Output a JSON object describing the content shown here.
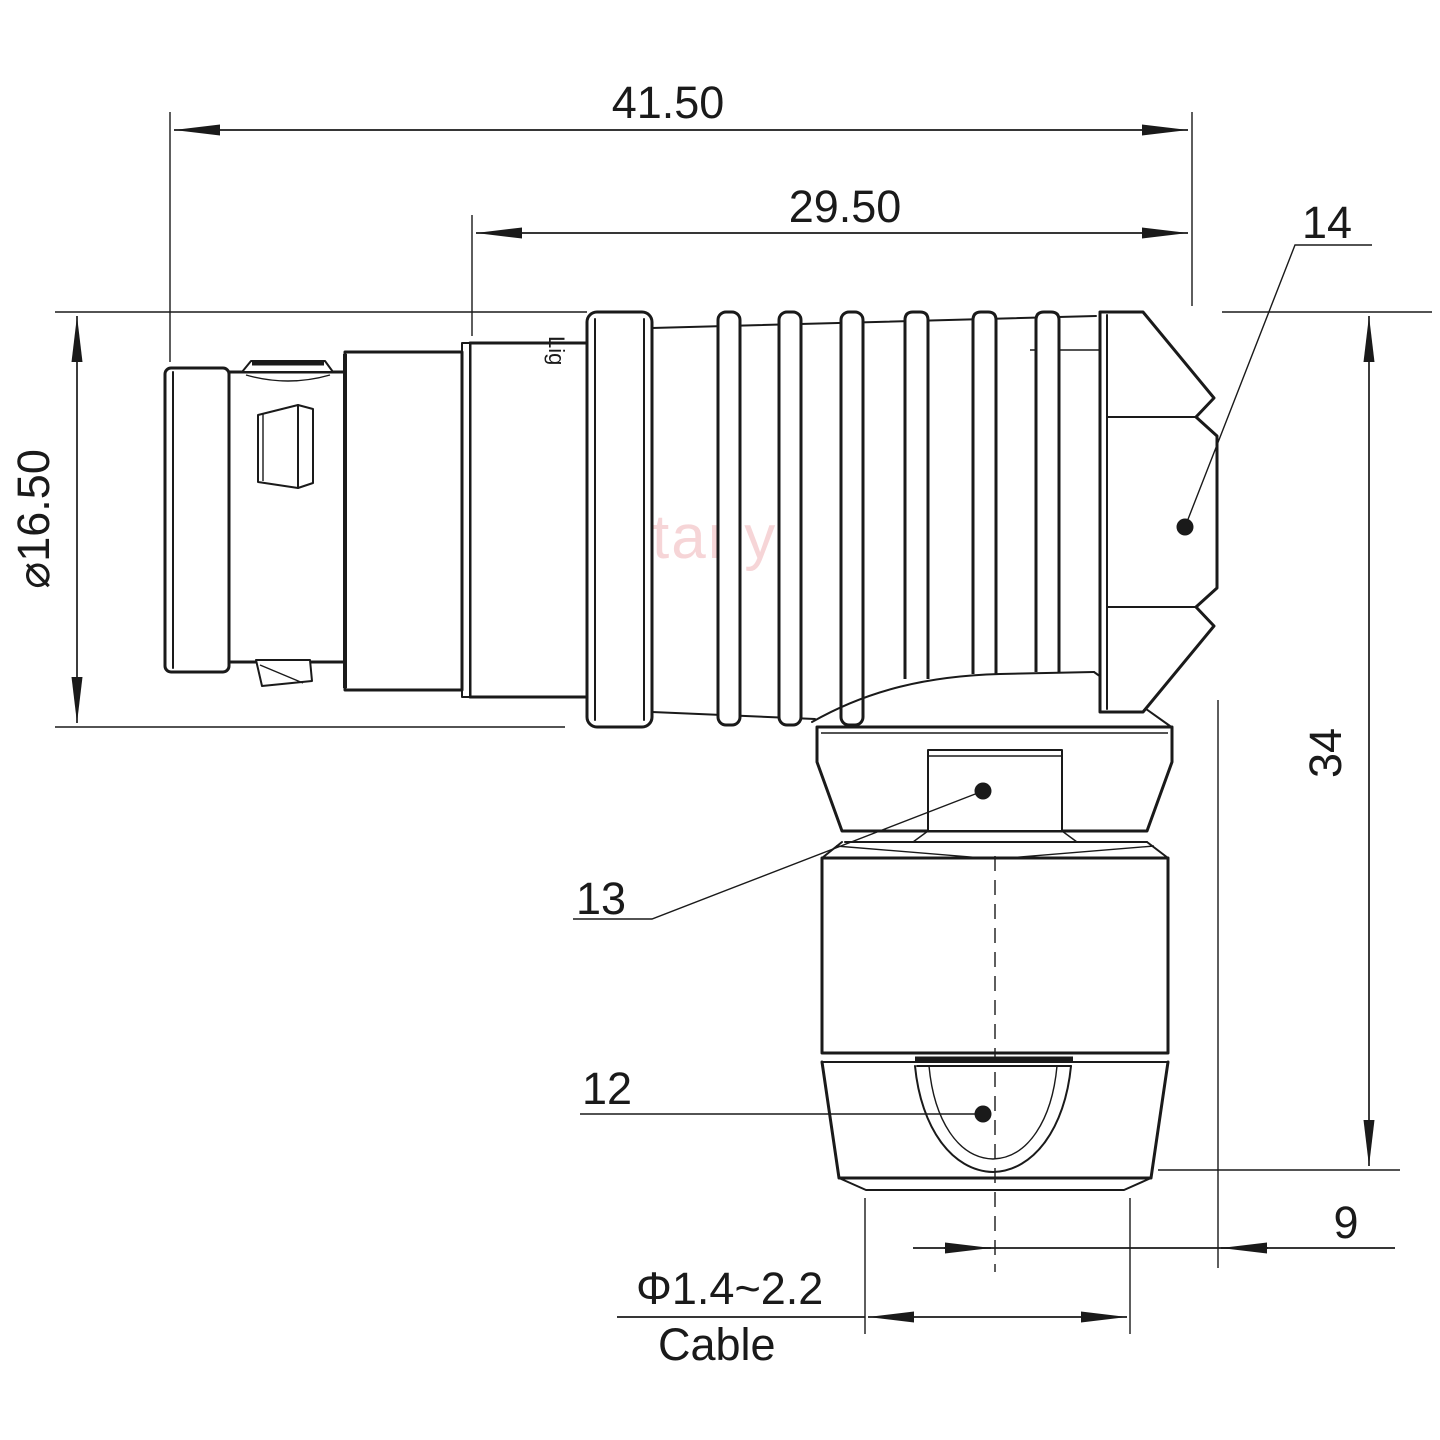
{
  "watermark": "Lightany",
  "engraving": "Lig",
  "dimensions": {
    "overall_length": "41.50",
    "body_length": "29.50",
    "front_diameter": "⌀16.50",
    "height": "34",
    "nut_offset": "9",
    "cable_diameter": "Φ1.4~2.2",
    "cable_word": "Cable"
  },
  "callouts": {
    "c14": "14",
    "c13": "13",
    "c12": "12"
  },
  "colors": {
    "line": "#1a1a1a",
    "watermark": "#f0b3b8",
    "background": "#ffffff"
  }
}
